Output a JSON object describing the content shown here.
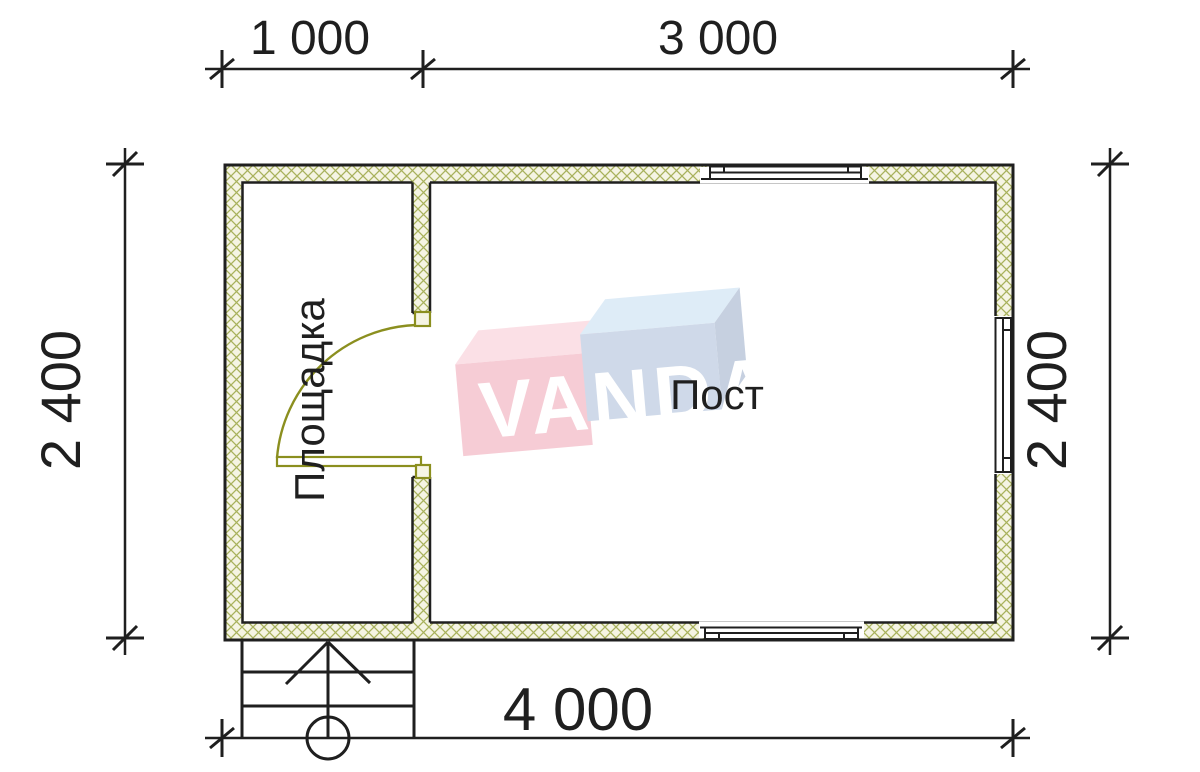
{
  "dimensions": {
    "top_left": "1 000",
    "top_right": "3 000",
    "side_left": "2 400",
    "side_right": "2 400",
    "bottom": "4 000"
  },
  "rooms": {
    "platform_label": "Площадка",
    "post_label": "Пост"
  },
  "watermark": {
    "text": "VANDA"
  },
  "colors": {
    "line": "#1f1f1f",
    "hatch-line": "#a8b15c",
    "hatch-fill": "#f5f4e3",
    "door": "#8b8f1f",
    "logo-pink-front": "#f6cad3",
    "logo-pink-top": "#fbdfe5",
    "logo-blue-front": "#cdd8e8",
    "logo-blue-top": "#ddebf7",
    "logo-blue-side": "#c3cedf"
  }
}
